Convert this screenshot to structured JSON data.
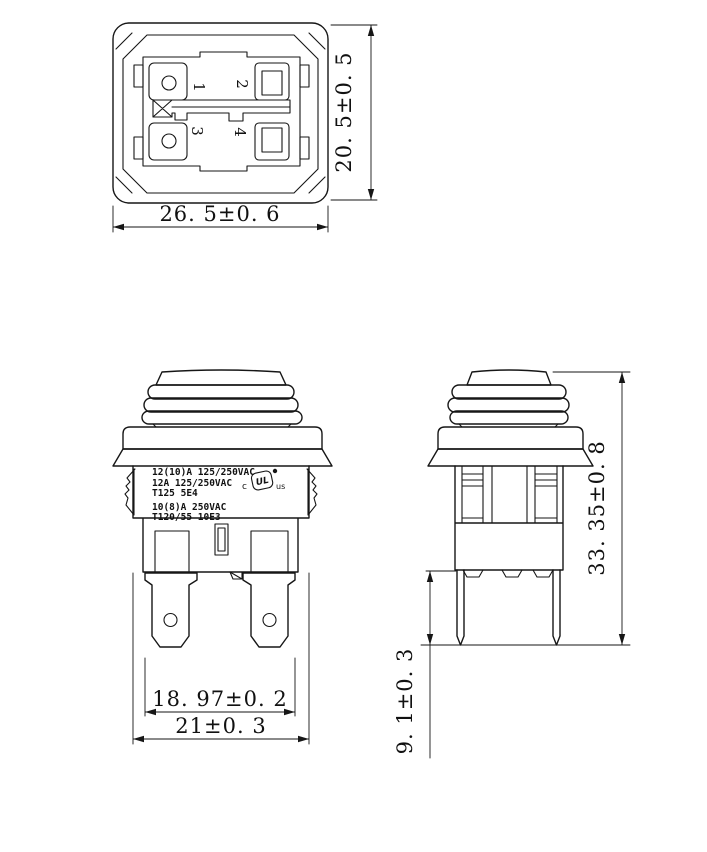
{
  "colors": {
    "ink": "#161616",
    "background": "#ffffff"
  },
  "views": {
    "bottom_view": {
      "terminal_numbers": [
        "1",
        "2",
        "3",
        "4"
      ],
      "dim_width": "26. 5±0. 6",
      "dim_height": "20. 5±0. 5"
    },
    "front_view": {
      "ratings": [
        "12(10)A 125/250VAC",
        "12A 125/250VAC",
        "T125 5E4",
        "10(8)A 250VAC",
        "T120/55 10E3"
      ],
      "cert": {
        "c": "c",
        "mark": "UL",
        "us": "us"
      },
      "dim_terminal_span": "18. 97±0. 2",
      "dim_body_width": "21±0. 3"
    },
    "side_view": {
      "dim_total_height": "33. 35±0. 8",
      "dim_pin_length": "9. 1±0. 3"
    }
  }
}
